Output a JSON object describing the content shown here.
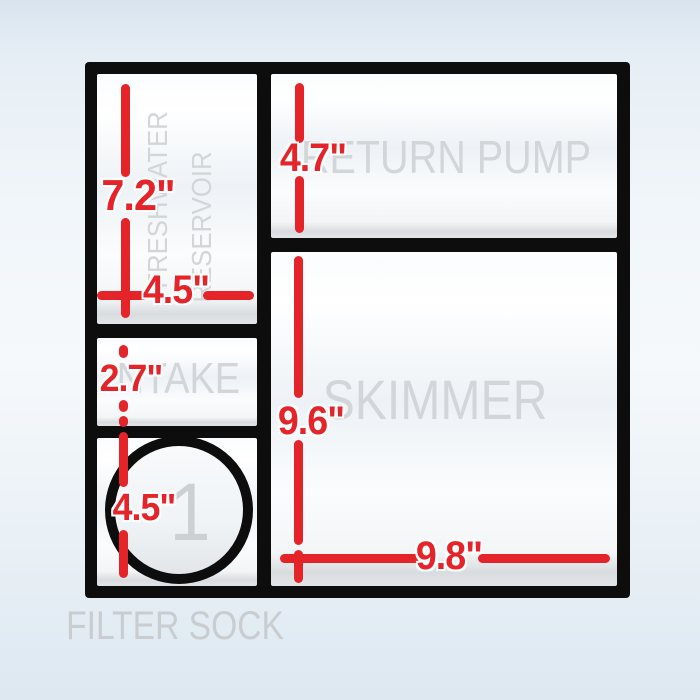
{
  "diagram": {
    "labels": {
      "freshwater_line1": "FRESHWATER",
      "freshwater_line2": "RESERVOIR",
      "return_pump": "RETURN PUMP",
      "intake": "INTAKE",
      "skimmer": "SKIMMER",
      "filter_sock": "FILTER SOCK",
      "hole_number": "1"
    },
    "dims": {
      "freshwater_height": "7.2\"",
      "freshwater_width": "4.5\"",
      "return_pump_height": "4.7\"",
      "intake_height": "2.7\"",
      "hole_diameter": "4.5\"",
      "skimmer_height": "9.6\"",
      "skimmer_width": "9.8\""
    },
    "colors": {
      "dimension_red": "#e5242a",
      "watermark_gray": "#d2d6d9",
      "frame_black": "#0d0d0d"
    }
  }
}
